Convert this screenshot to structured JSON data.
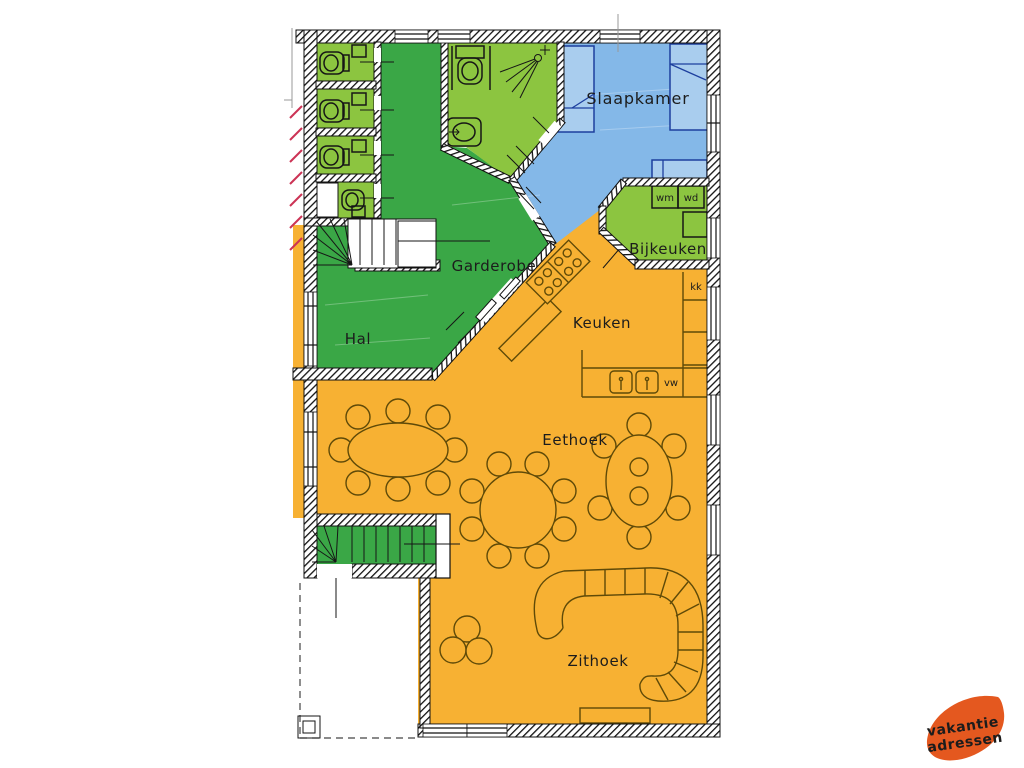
{
  "labels": {
    "slaapkamer": "Slaapkamer",
    "bijkeuken": "Bijkeuken",
    "garderobe": "Garderobe",
    "hal": "Hal",
    "keuken": "Keuken",
    "eethoek": "Eethoek",
    "zithoek": "Zithoek"
  },
  "appliance_labels": {
    "wm": "wm",
    "wd": "wd",
    "kk": "kk",
    "vw": "vw"
  },
  "logo": {
    "line1": "vakantie",
    "line2": "adressen",
    "background_color": "#e4581f",
    "text_color": "#ffffff"
  },
  "colors": {
    "hall_green": "#3aa746",
    "room_green": "#8cc540",
    "bedroom_blue": "#84b8e8",
    "living_orange": "#f7b133",
    "bed_fill": "#a9cdee",
    "wall_black": "#111111",
    "furniture_line": "#5f4a08",
    "red_tick": "#cc3355"
  }
}
